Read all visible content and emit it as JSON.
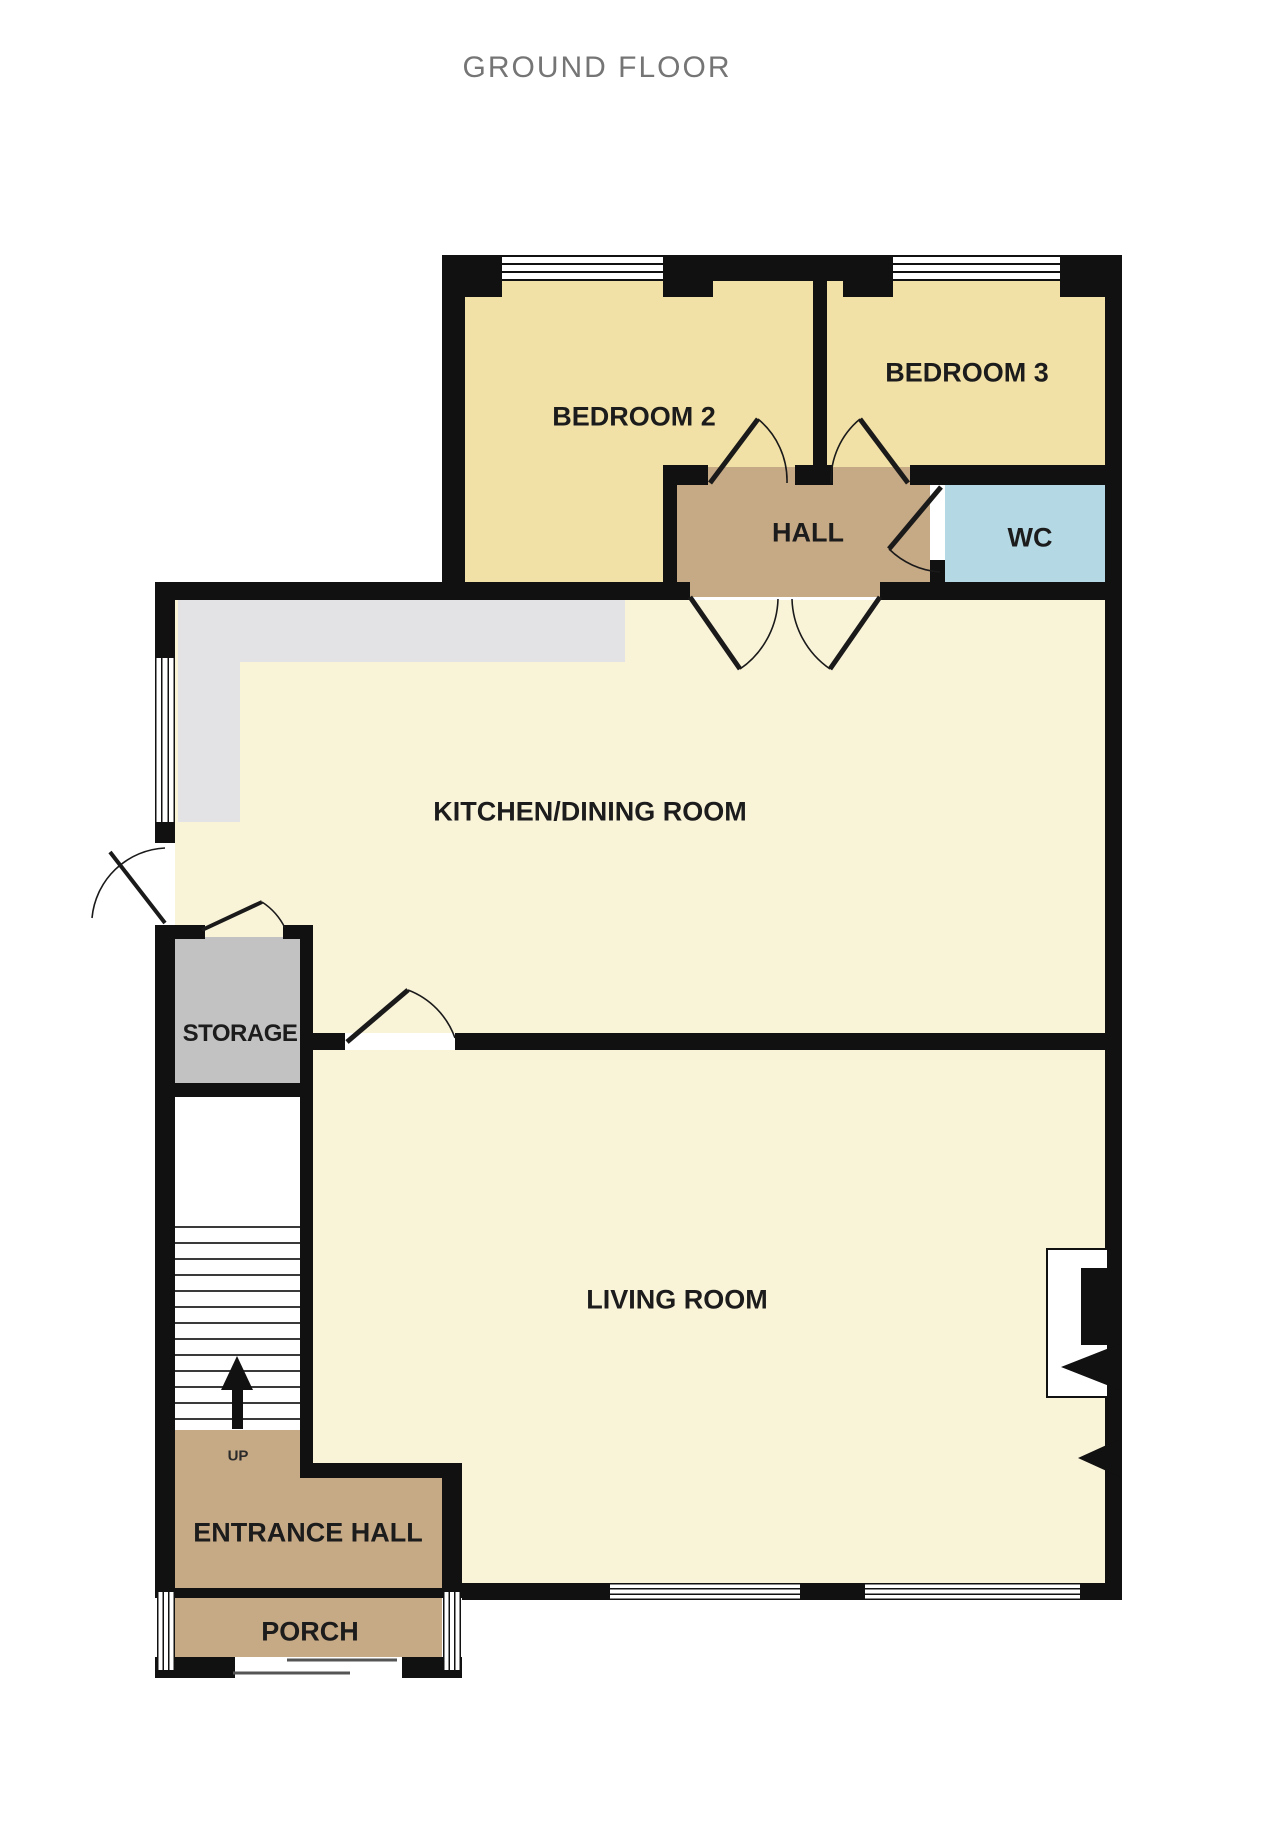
{
  "title": "GROUND FLOOR",
  "rooms": {
    "bedroom2": {
      "label": "BEDROOM 2"
    },
    "bedroom3": {
      "label": "BEDROOM 3"
    },
    "hall": {
      "label": "HALL"
    },
    "wc": {
      "label": "WC"
    },
    "kitchen": {
      "label": "KITCHEN/DINING ROOM"
    },
    "storage": {
      "label": "STORAGE"
    },
    "living": {
      "label": "LIVING ROOM"
    },
    "entrance": {
      "label": "ENTRANCE HALL"
    },
    "porch": {
      "label": "PORCH"
    }
  },
  "stairs": {
    "direction_label": "UP"
  },
  "colors": {
    "wall": "#111111",
    "bedroom_floor": "#f2e1a6",
    "pale_floor": "#f9f3d8",
    "hall_floor": "#c6a985",
    "wc_floor": "#b4d9e4",
    "storage_floor": "#c2c2c2",
    "counter": "#e3e3e5",
    "stairs_floor": "#ffffff",
    "title_text": "#757575",
    "label_text": "#1c1c1c"
  }
}
